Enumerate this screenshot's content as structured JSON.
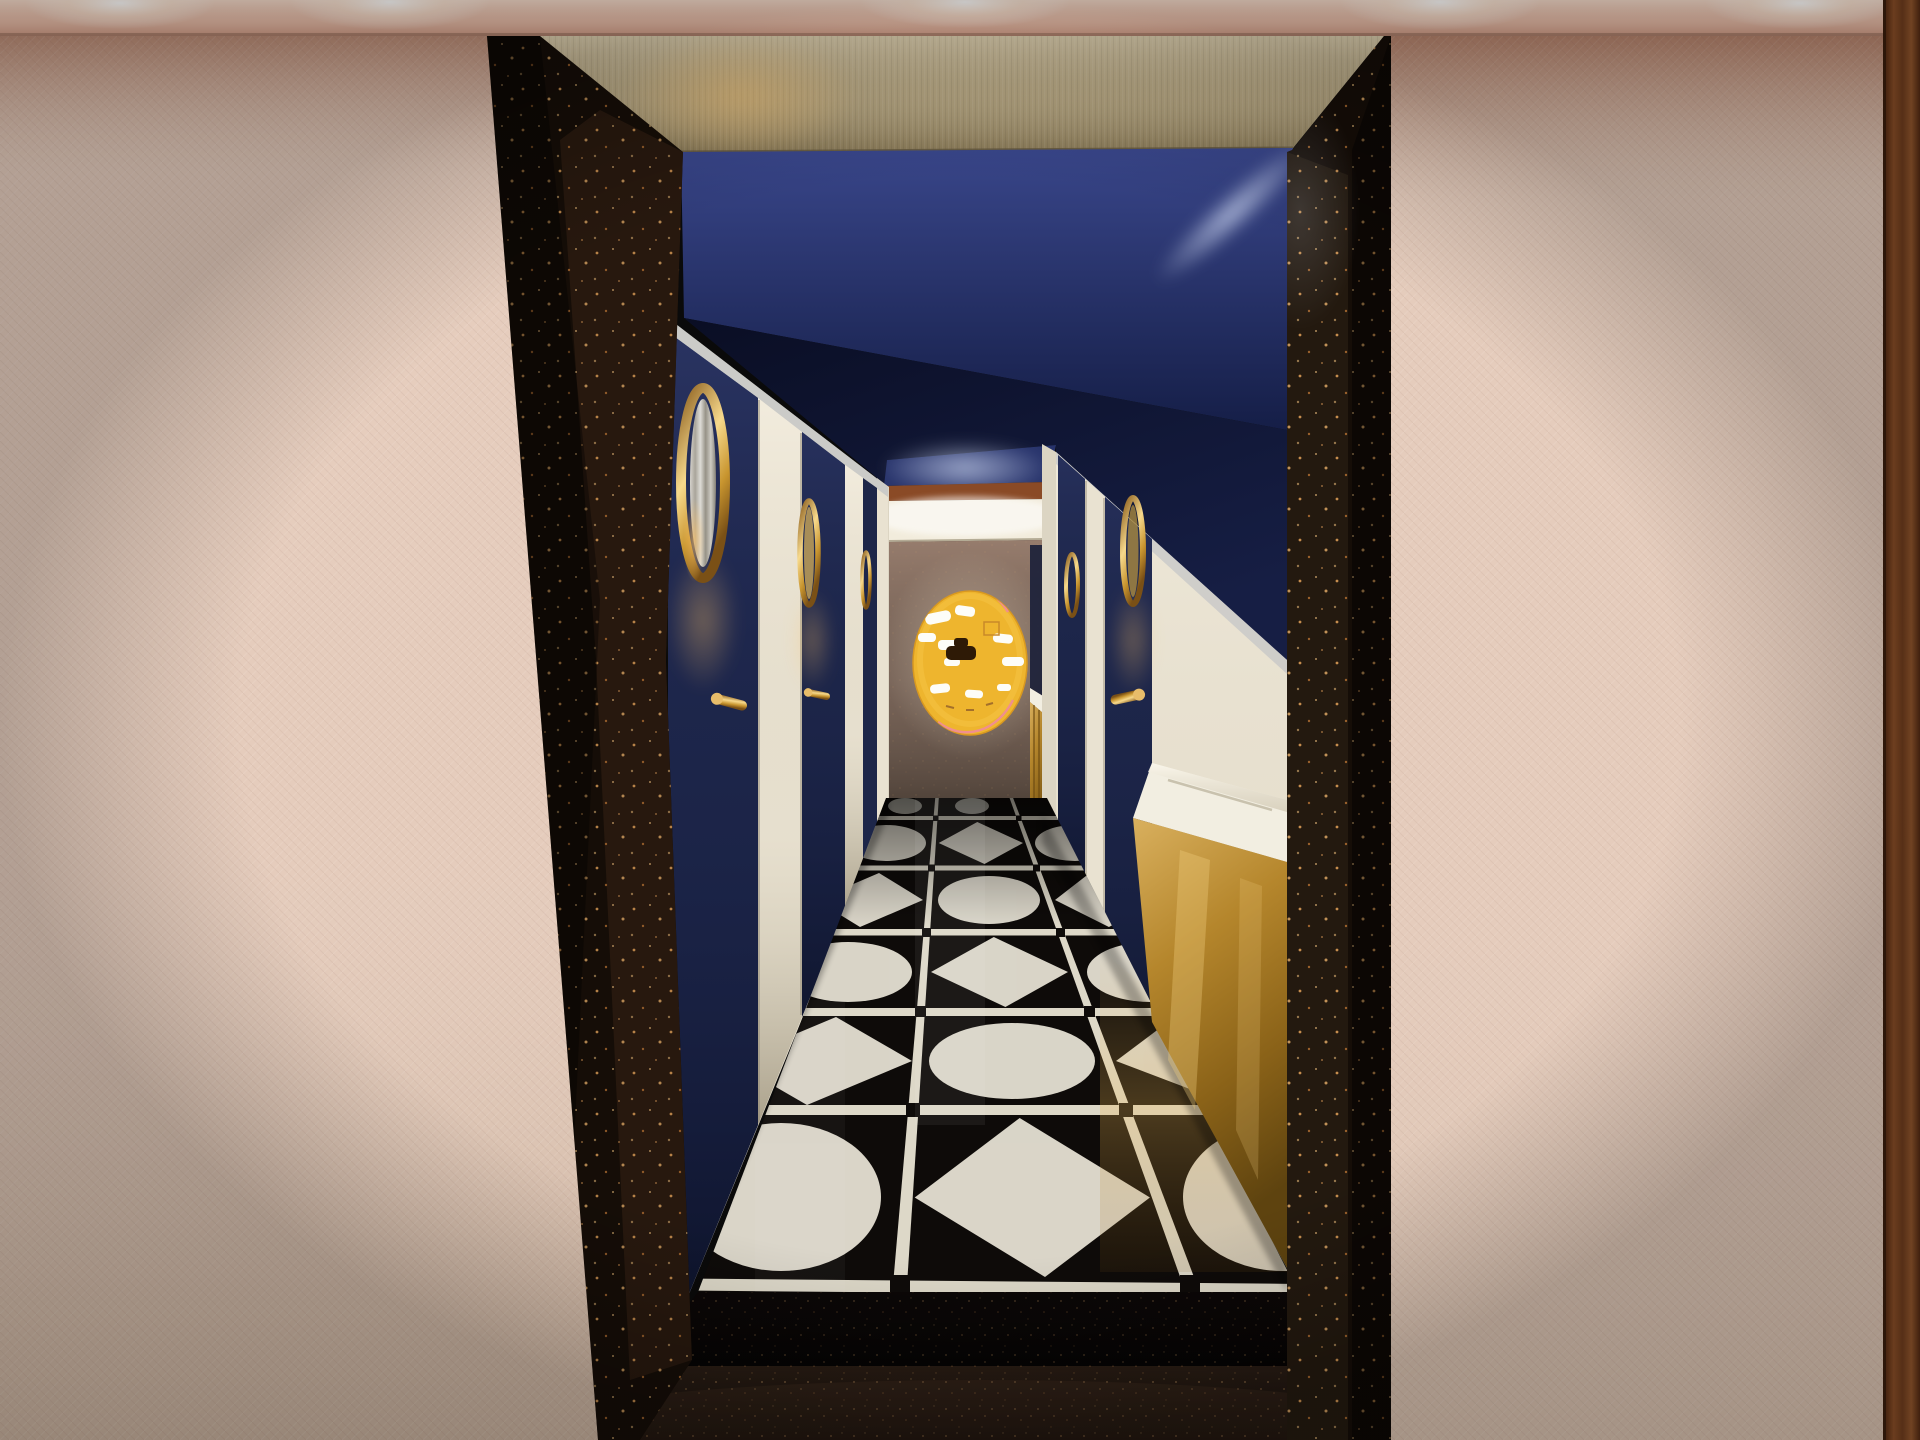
{
  "scene": {
    "type": "interior-3d-render",
    "alt": "One-point-perspective 3D rendering of a narrow hotel washroom corridor. Blush textured wallpaper walls and black gold-flecked terrazzo pillars frame the opening under a rose-metal light band with recessed spotlights. Inside, a champagne brass fascia tops a navy ceiling; navy doors with brass porthole mirrors and lever handles line both sides; a white vanity counter with a brass-clad front stands on the right; the glossy black floor is patterned with white circles and diamonds in a grid of white grout; at the far end a mustard-yellow circular artwork with abstract white motifs hangs on a taupe wall beneath a glowing white lintel and rust transom.",
    "visible_text": "none"
  },
  "palette": {
    "band_pink": "#e9c2ae",
    "wallpaper_blush": "#e5ccbc",
    "wood_mahogany": "#80451f",
    "fascia_brass": "#b5a581",
    "pillar_terrazzo_black": "#150d07",
    "pillar_fleck_gold": "#d99a55",
    "ceiling_navy": "#27336b",
    "ceiling_shadow_navy": "#0c1128",
    "door_navy": "#1d2649",
    "frame_white": "#e9e2d1",
    "brass_gold": "#c8952f",
    "brass_highlight": "#f6d98e",
    "rust_brown": "#8a4a26",
    "lintel_white": "#f2ecdc",
    "end_wall_taupe": "#7d685c",
    "artwork_yellow": "#eeb52e",
    "artwork_pink": "#ef8d93",
    "artwork_brown": "#2e1a06",
    "tile_black": "#0e0b09",
    "grout_white": "#ddd8c8",
    "tile_white": "#e9e5d7",
    "counter_white": "#f2eee1",
    "vanity_gold": "#b5862c",
    "riser_black": "#0a0606",
    "foreground_terrazzo": "#1d1410",
    "cornice_grey": "#b8bcc2",
    "jamb_white": "#dcd5c3",
    "glow_white": "#ffffff"
  },
  "lighting": {
    "band_spotlight_count": 5,
    "far_end_glow": true,
    "ceiling_light_streak": true,
    "porthole_underglow": true
  }
}
